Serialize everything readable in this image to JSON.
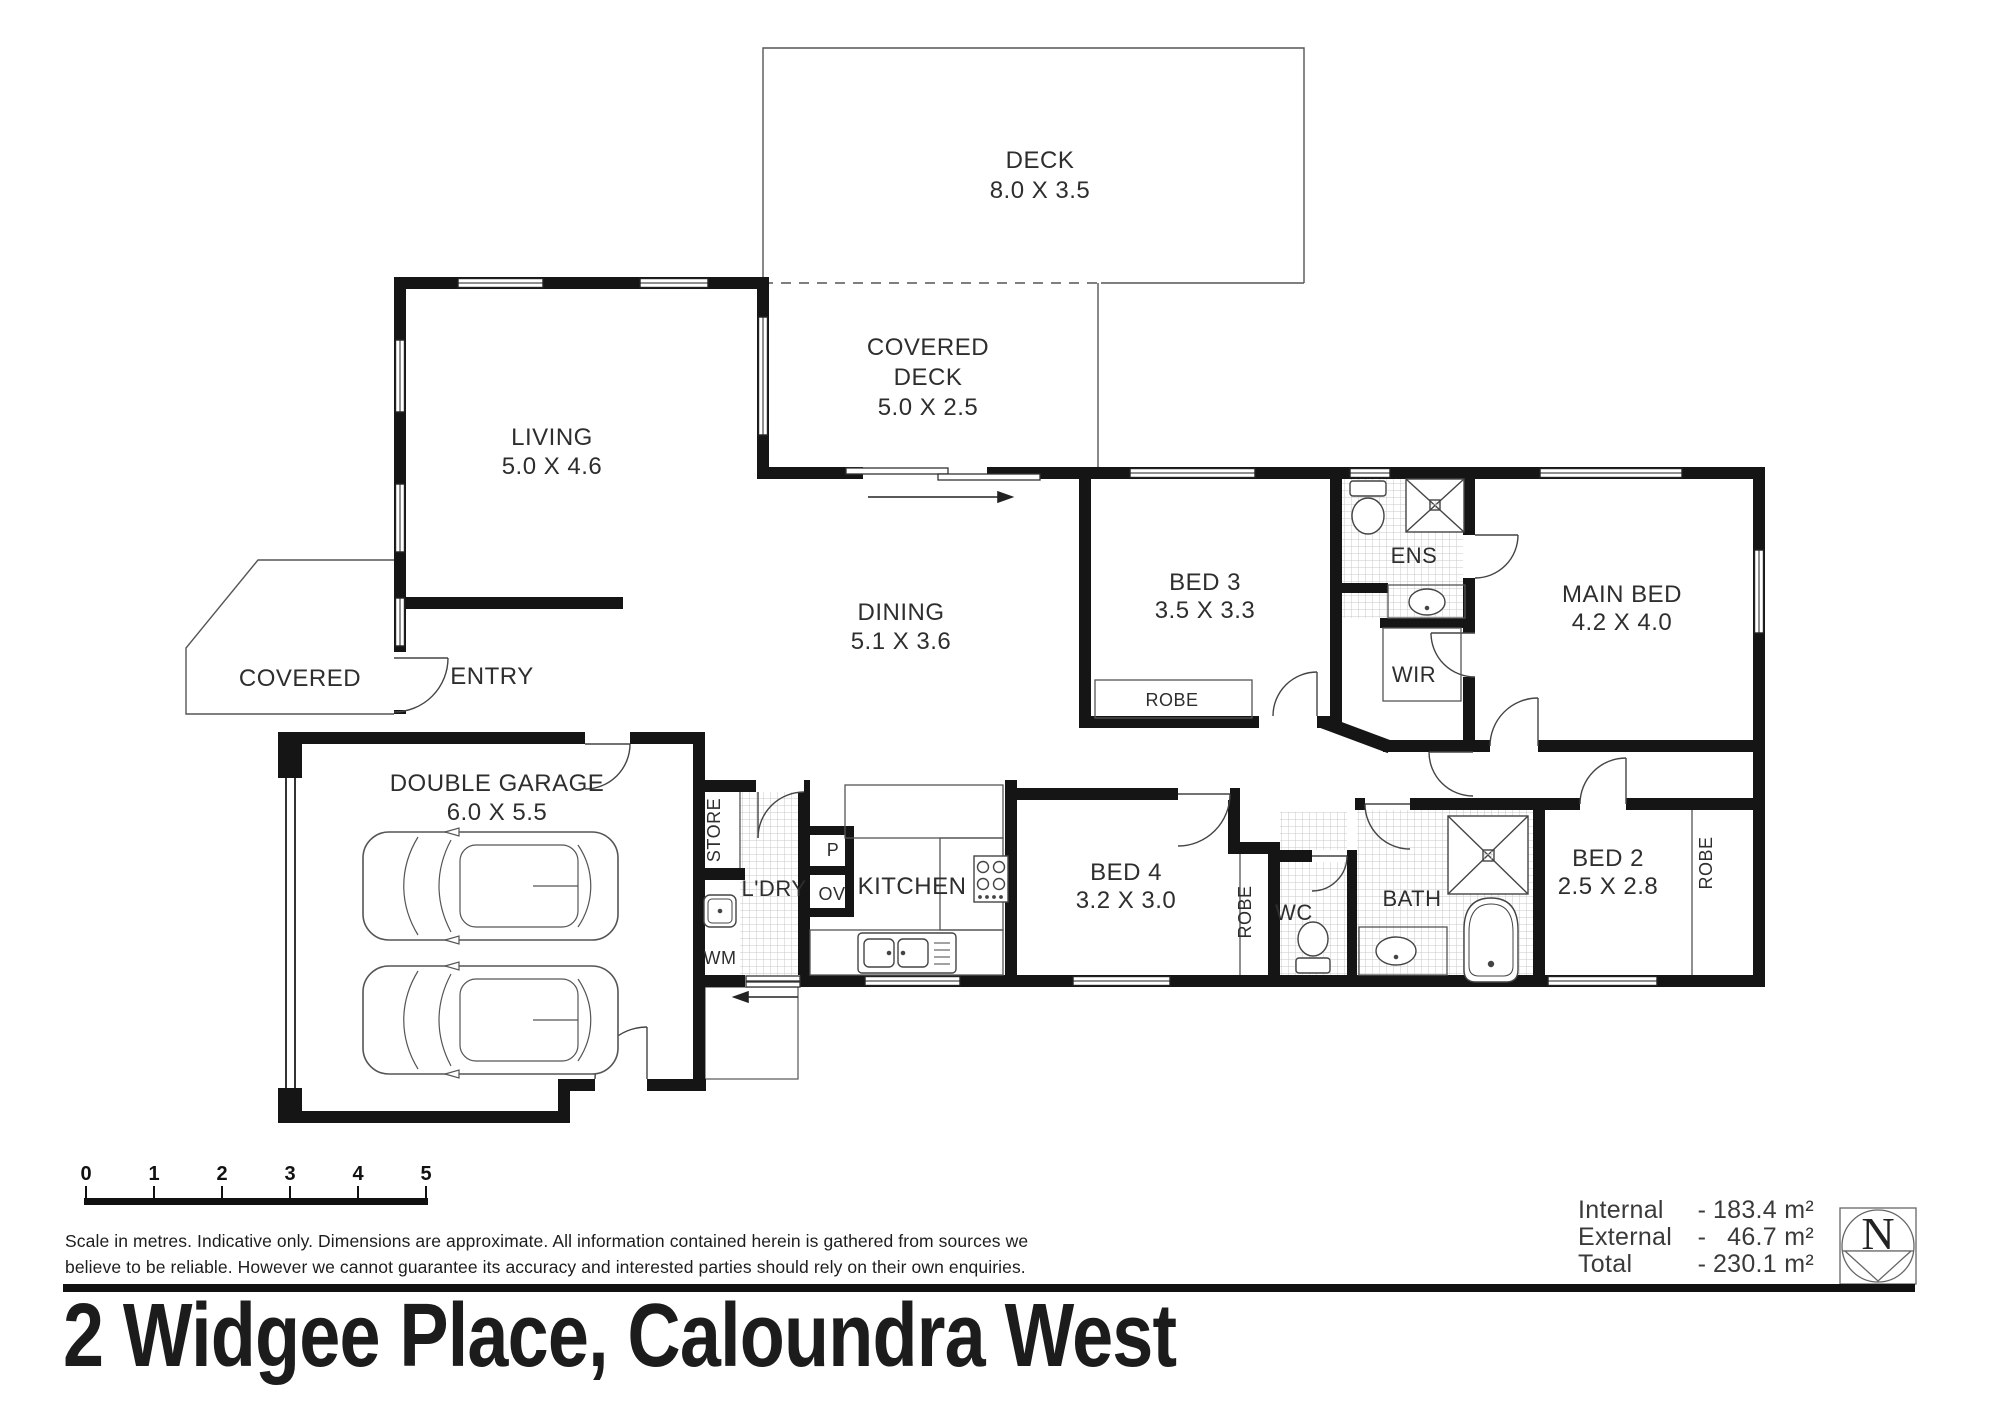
{
  "title": "2 Widgee Place, Caloundra West",
  "rooms": {
    "deck": {
      "name": "DECK",
      "dims": "8.0 X 3.5"
    },
    "covered_deck": {
      "line1": "COVERED",
      "line2": "DECK",
      "dims": "5.0 X 2.5"
    },
    "living": {
      "name": "LIVING",
      "dims": "5.0 X 4.6"
    },
    "dining": {
      "name": "DINING",
      "dims": "5.1 X 3.6"
    },
    "entry": {
      "name": "ENTRY"
    },
    "porch": {
      "name": "COVERED"
    },
    "garage": {
      "name": "DOUBLE GARAGE",
      "dims": "6.0 X 5.5"
    },
    "bed3": {
      "name": "BED 3",
      "dims": "3.5 X 3.3"
    },
    "main_bed": {
      "name": "MAIN BED",
      "dims": "4.2 X 4.0"
    },
    "ens": {
      "name": "ENS"
    },
    "wir": {
      "name": "WIR"
    },
    "bed4": {
      "name": "BED 4",
      "dims": "3.2 X 3.0"
    },
    "bed2": {
      "name": "BED 2",
      "dims": "2.5 X 2.8"
    },
    "bath": {
      "name": "BATH"
    },
    "wc": {
      "name": "WC"
    },
    "kitchen": {
      "name": "KITCHEN"
    },
    "ldry": {
      "name": "L'DRY"
    },
    "store": {
      "name": "STORE"
    },
    "wm": {
      "name": "WM"
    },
    "pantry": {
      "name": "P"
    },
    "oven": {
      "name": "OV"
    }
  },
  "robes": {
    "bed3": "ROBE",
    "bed4": "ROBE",
    "bed2": "ROBE"
  },
  "footer": {
    "scale": {
      "ticks": [
        "0",
        "1",
        "2",
        "3",
        "4",
        "5"
      ]
    },
    "disclaimer": {
      "line1": "Scale in metres. Indicative only. Dimensions are approximate. All information contained herein is gathered from sources we",
      "line2": "believe to be reliable. However we cannot guarantee its accuracy and interested parties should rely on their own enquiries."
    },
    "areas": [
      {
        "label": "Internal",
        "sep": "-",
        "value": "183.4 m²"
      },
      {
        "label": "External",
        "sep": "-",
        "value": "46.7 m²"
      },
      {
        "label": "Total",
        "sep": "-",
        "value": "230.1 m²"
      }
    ],
    "compass": {
      "letter": "N"
    }
  }
}
